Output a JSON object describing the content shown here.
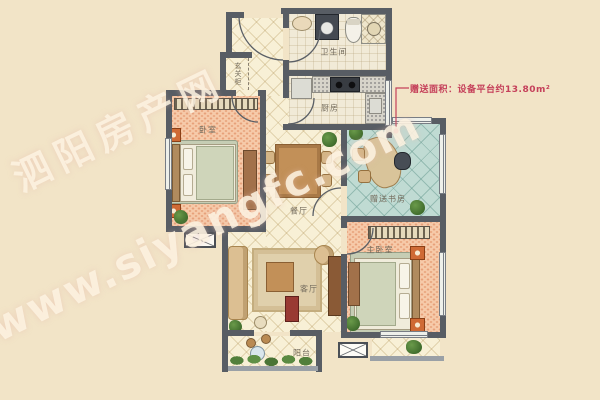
{
  "watermark": {
    "site_name": "泗阳房产网",
    "site_url": "www.siyangfc.com"
  },
  "annotation": {
    "gift_area_note": "赠送面积：设备平台约13.80m²"
  },
  "rooms": {
    "bedroom": {
      "label": "卧室"
    },
    "bathroom": {
      "label": "卫生间"
    },
    "kitchen": {
      "label": "厨房"
    },
    "dining": {
      "label": "餐厅"
    },
    "study": {
      "label": "赠送书房"
    },
    "living": {
      "label": "客厅"
    },
    "master": {
      "label": "主卧室"
    },
    "balcony": {
      "label": "阳台"
    },
    "foyer": {
      "label": "玄关柜"
    }
  },
  "colors": {
    "background": "#f2e4c7",
    "wall": "#585d64",
    "annotation_red": "#c5405a",
    "bedroom_floor": "#f6caa9",
    "hall_floor": "#f8f0d6",
    "study_floor": "#c0dbd3"
  }
}
